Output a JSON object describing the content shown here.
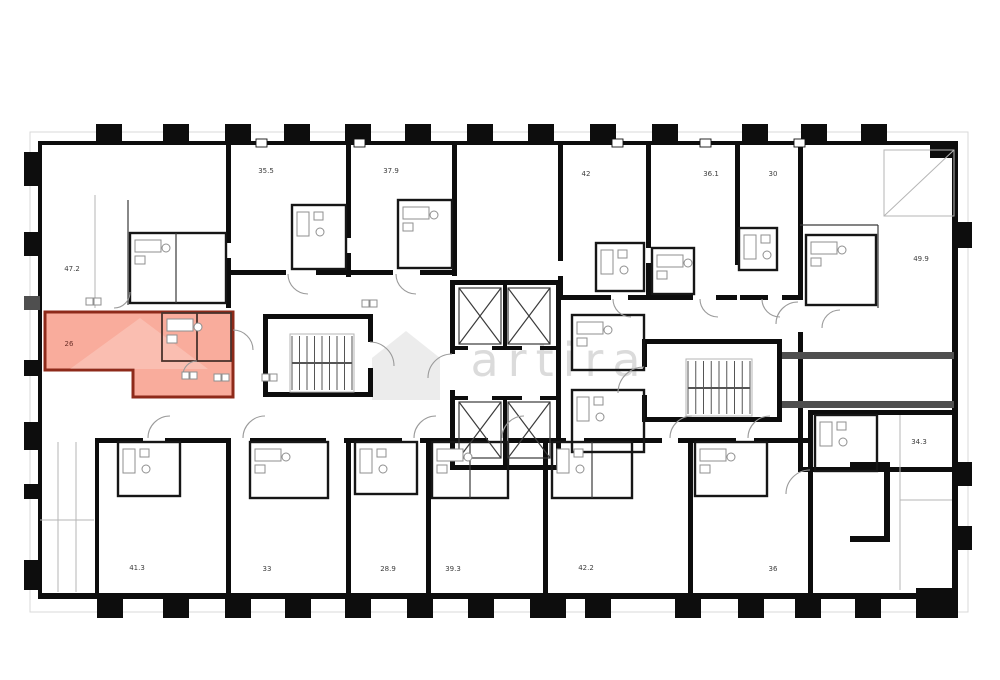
{
  "image": {
    "type": "building-floor-plan",
    "background": "#ffffff"
  },
  "watermark": {
    "text": "artira",
    "color": "rgba(135,135,135,0.30)"
  },
  "highlight": {
    "fill": "rgba(246,140,118,0.72)",
    "border": "#8e2a1a",
    "description": "selected apartment highlighted in red"
  },
  "colors": {
    "walls": "#0d0d0d",
    "thin_walls": "#3a3a3a",
    "fixtures": "#8f8f8f",
    "gray_wall": "#4f4f4f",
    "plan_frame": "#d9d9d9"
  },
  "units": [
    {
      "id": "unit-47-2",
      "area": "47.2"
    },
    {
      "id": "unit-35-5",
      "area": "35.5"
    },
    {
      "id": "unit-37-9",
      "area": "37.9"
    },
    {
      "id": "unit-42",
      "area": "42"
    },
    {
      "id": "unit-36-1",
      "area": "36.1"
    },
    {
      "id": "unit-30",
      "area": "30"
    },
    {
      "id": "unit-49-9",
      "area": "49.9"
    },
    {
      "id": "unit-26-selected",
      "area": "26"
    },
    {
      "id": "unit-34-3",
      "area": "34.3"
    },
    {
      "id": "unit-41-3",
      "area": "41.3"
    },
    {
      "id": "unit-33",
      "area": "33"
    },
    {
      "id": "unit-28-9",
      "area": "28.9"
    },
    {
      "id": "unit-39-3",
      "area": "39.3"
    },
    {
      "id": "unit-42-2",
      "area": "42.2"
    },
    {
      "id": "unit-36",
      "area": "36"
    }
  ]
}
